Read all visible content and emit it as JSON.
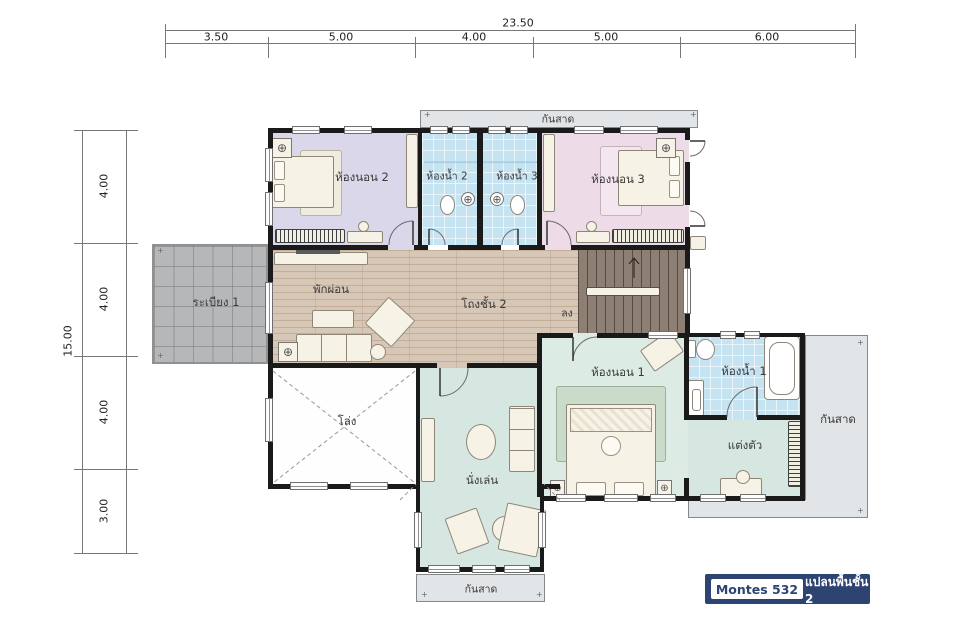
{
  "dimensions": {
    "top": {
      "total": "23.50",
      "segments": [
        "3.50",
        "5.00",
        "4.00",
        "5.00",
        "6.00"
      ]
    },
    "left": {
      "total": "15.00",
      "segments": [
        "4.00",
        "4.00",
        "4.00",
        "3.00"
      ]
    }
  },
  "rooms": {
    "bedroom2": "ห้องนอน 2",
    "bathroom2": "ห้องน้ำ 2",
    "bathroom3": "ห้องน้ำ 3",
    "bedroom3": "ห้องนอน 3",
    "balcony1": "ระเบียง 1",
    "relax": "พักผ่อน",
    "hall_floor2": "โถงชั้น 2",
    "bedroom1": "ห้องนอน 1",
    "bathroom1": "ห้องน้ำ 1",
    "dressing": "แต่งตัว",
    "void_open": "โล่ง",
    "sitting": "นั่งเล่น"
  },
  "annotations": {
    "awning": "กันสาด",
    "stairs_down": "ลง"
  },
  "legend": {
    "model": "Montes 532",
    "plan_title": "แปลนพื้นชั้น 2"
  },
  "icons": {
    "ceiling_register": "⊕",
    "fastener": "+"
  },
  "colors": {
    "bedroom_lavender": "#dad7ea",
    "bedroom_pink": "#eddbe7",
    "bedroom_green": "#dcebe3",
    "living_mint": "#d6e7e1",
    "bath_blue": "#c6e3f2",
    "wood_floor": "#d7c7b6",
    "stairs_brown": "#8d7f73",
    "balcony_gray": "#b6b7b9",
    "awning_gray": "#e2e5e7",
    "wall_black": "#1a1a1a",
    "legend_navy": "#2d4473"
  }
}
